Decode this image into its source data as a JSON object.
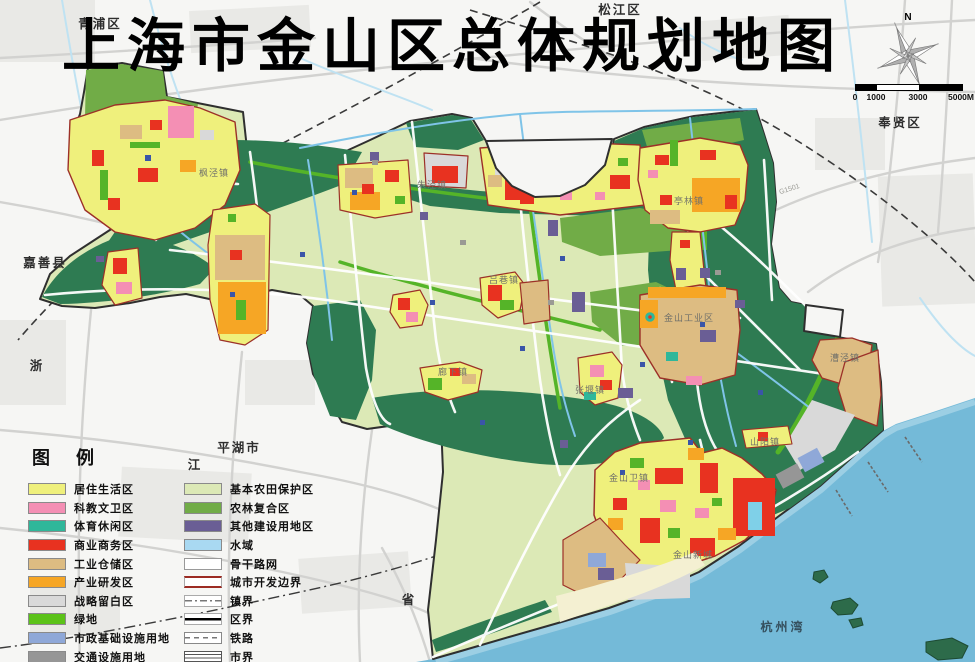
{
  "title": "上海市金山区总体规划地图",
  "compass": {
    "north_label": "N"
  },
  "scale_bar": {
    "ticks": [
      "0",
      "1000",
      "3000",
      "5000M"
    ],
    "tick_offsets": [
      0,
      21,
      63,
      106
    ]
  },
  "legend": {
    "title": "图例",
    "left_items": [
      {
        "label": "居住生活区",
        "type": "swatch",
        "color": "#EFF07C"
      },
      {
        "label": "科教文卫区",
        "type": "swatch",
        "color": "#F48FB4"
      },
      {
        "label": "体育休闲区",
        "type": "swatch",
        "color": "#2FB79A"
      },
      {
        "label": "商业商务区",
        "type": "swatch",
        "color": "#E83220"
      },
      {
        "label": "工业仓储区",
        "type": "swatch",
        "color": "#DDBC82"
      },
      {
        "label": "产业研发区",
        "type": "swatch",
        "color": "#F6A625"
      },
      {
        "label": "战略留白区",
        "type": "swatch",
        "color": "#D9D9D9"
      },
      {
        "label": "绿地",
        "type": "swatch",
        "color": "#5BC218"
      },
      {
        "label": "市政基础设施用地",
        "type": "swatch",
        "color": "#8FA8D8"
      },
      {
        "label": "交通设施用地",
        "type": "swatch",
        "color": "#969696"
      },
      {
        "label": "一、二类生态空间",
        "type": "swatch",
        "color": "#2E7B52"
      }
    ],
    "right_items": [
      {
        "label": "基本农田保护区",
        "type": "swatch",
        "color": "#DCE9B6"
      },
      {
        "label": "农林复合区",
        "type": "swatch",
        "color": "#71AC47"
      },
      {
        "label": "其他建设用地区",
        "type": "swatch",
        "color": "#6A5E95"
      },
      {
        "label": "水域",
        "type": "swatch",
        "color": "#A9D9F2"
      },
      {
        "label": "骨干路网",
        "type": "line-road"
      },
      {
        "label": "城市开发边界",
        "type": "line-redline",
        "color": "#9C2B23"
      },
      {
        "label": "镇界",
        "type": "line-dashdot"
      },
      {
        "label": "区界",
        "type": "line-solid"
      },
      {
        "label": "铁路",
        "type": "line-rail"
      },
      {
        "label": "市界",
        "type": "line-hatch"
      }
    ]
  },
  "map_labels": {
    "regions": [
      {
        "text": "青浦区",
        "x": 100,
        "y": 28
      },
      {
        "text": "松江区",
        "x": 620,
        "y": 14
      },
      {
        "text": "奉贤区",
        "x": 900,
        "y": 127
      },
      {
        "text": "嘉善县",
        "x": 45,
        "y": 267
      },
      {
        "text": "平湖市",
        "x": 239,
        "y": 452
      },
      {
        "text": "浙",
        "x": 37,
        "y": 370
      },
      {
        "text": "江",
        "x": 195,
        "y": 469
      },
      {
        "text": "省",
        "x": 409,
        "y": 604
      }
    ],
    "towns": [
      {
        "text": "枫泾镇",
        "x": 214,
        "y": 176
      },
      {
        "text": "朱泾镇",
        "x": 432,
        "y": 188
      },
      {
        "text": "亭林镇",
        "x": 689,
        "y": 204
      },
      {
        "text": "吕巷镇",
        "x": 504,
        "y": 283
      },
      {
        "text": "廊下镇",
        "x": 453,
        "y": 375
      },
      {
        "text": "张堰镇",
        "x": 590,
        "y": 393
      },
      {
        "text": "金山工业区",
        "x": 689,
        "y": 321
      },
      {
        "text": "漕泾镇",
        "x": 845,
        "y": 361
      },
      {
        "text": "山阳镇",
        "x": 765,
        "y": 445
      },
      {
        "text": "金山卫镇",
        "x": 629,
        "y": 481
      },
      {
        "text": "金山新城",
        "x": 693,
        "y": 558
      }
    ],
    "water": [
      {
        "text": "杭州湾",
        "x": 783,
        "y": 631
      }
    ],
    "roads": [
      {
        "text": "G1501",
        "x": 790,
        "y": 191,
        "angle": -18
      }
    ]
  },
  "colors": {
    "sea": "#74BAD8",
    "near_shore": "#A9D6E8",
    "farmland": "#DCE9B6",
    "eco_green": "#2E7B52",
    "forest_green": "#71AC47",
    "outside_land": "#F6F6F4",
    "boundary": "#2F2F2F",
    "dev_boundary": "#9C3028"
  }
}
